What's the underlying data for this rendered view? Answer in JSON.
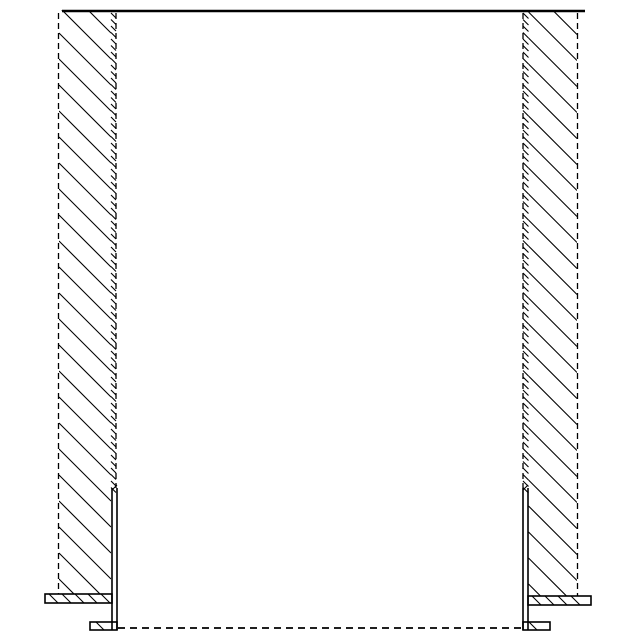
{
  "drawing": {
    "title": "wall-opening-section-with-edge-angle-profiles",
    "background": "#ffffff",
    "stroke_color": "#000000",
    "canvas": {
      "width": 640,
      "height": 640
    },
    "line_width": 1.6,
    "hatch_width": 1.1,
    "dashed_width": 1.3,
    "dash_pattern": "6 4",
    "top_edge": {
      "x1": 62,
      "x2": 585,
      "y": 11,
      "width": 2.6
    },
    "walls": [
      {
        "name": "left-wall",
        "top": 10,
        "bottom": 594,
        "hatch": {
          "x1": 59,
          "x2": 111,
          "spacing": 26,
          "phase": 7
        },
        "outer_dashed": {
          "x": 58.5,
          "y1": 13,
          "y2": 594
        },
        "inner_dashed": {
          "x": 116,
          "y1": 13,
          "y2": 488
        },
        "strip": {
          "x1": 111,
          "x2": 116,
          "y1": 13,
          "y2": 488,
          "spacing": 6.5
        }
      },
      {
        "name": "right-wall",
        "top": 10,
        "bottom": 596,
        "hatch": {
          "x1": 528.5,
          "x2": 577,
          "spacing": 26,
          "phase": 12
        },
        "outer_dashed": {
          "x": 577.5,
          "y1": 13,
          "y2": 596
        },
        "inner_dashed": {
          "x": 523,
          "y1": 13,
          "y2": 488
        },
        "strip": {
          "x1": 523,
          "x2": 528.5,
          "y1": 13,
          "y2": 488,
          "spacing": 6.5
        }
      }
    ],
    "profiles": [
      {
        "name": "left-edge-angle",
        "bar": {
          "x1": 112,
          "x2": 117,
          "top": 488,
          "bottom": 630
        },
        "flange": {
          "x1": 45,
          "x2": 112,
          "y1": 594,
          "y2": 603,
          "tick_spacing": 13
        },
        "foot": {
          "x1": 90,
          "x2": 117,
          "y1": 622,
          "y2": 630
        }
      },
      {
        "name": "right-edge-angle",
        "bar": {
          "x1": 523,
          "x2": 528,
          "top": 488,
          "bottom": 630
        },
        "flange": {
          "x1": 528,
          "x2": 591,
          "y1": 596,
          "y2": 605,
          "tick_spacing": 13
        },
        "foot": {
          "x1": 523,
          "x2": 550,
          "y1": 622,
          "y2": 630
        }
      }
    ],
    "floor_line": {
      "x1": 118,
      "x2": 522,
      "y": 628,
      "dash": "7 5",
      "width": 1.7
    }
  }
}
